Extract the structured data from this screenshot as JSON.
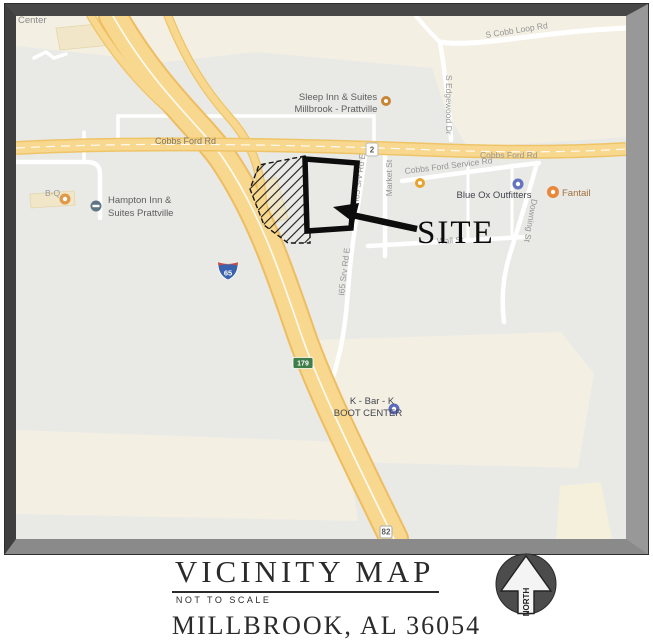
{
  "map": {
    "partial_label_top_left": "Center",
    "roads": {
      "s_cobb_loop": "S Cobb Loop Rd",
      "s_edgewood": "S Edgewood Dr",
      "cobbs_ford_left": "Cobbs Ford Rd",
      "cobbs_ford_right": "Cobbs Ford Rd",
      "cobbs_ford_service": "Cobbs Ford Service Rd",
      "market": "Market St",
      "srv_rd_upper": "I65 Srv Rd E",
      "srv_rd_lower": "I65 Srv Rd E",
      "wall": "Wall St",
      "downing": "Downing St"
    },
    "pois": {
      "bq": "B-Q",
      "sleep_inn_1": "Sleep Inn & Suites",
      "sleep_inn_2": "Millbrook - Prattville",
      "hampton_1": "Hampton Inn &",
      "hampton_2": "Suites Prattville",
      "blue_ox": "Blue Ox Outfitters",
      "fantail": "Fantail",
      "kbark_1": "K - Bar - K",
      "kbark_2": "BOOT CENTER"
    },
    "shields": {
      "state_2": "2",
      "interstate_65": "65",
      "state_179": "179",
      "us_82": "82"
    },
    "annotation": {
      "site": "SITE"
    }
  },
  "footer": {
    "title": "VICINITY MAP",
    "scale_note": "NOT TO SCALE",
    "location": "MILLBROOK, AL 36054",
    "north": "NORTH"
  },
  "colors": {
    "map_bg": "#e9e9e6",
    "commercial_area": "#f3efe3",
    "highway": "#f8d88e",
    "highway_edge": "#eec467",
    "annotation": "#0d0d0d",
    "frame_gray": "#8a8a8a"
  }
}
